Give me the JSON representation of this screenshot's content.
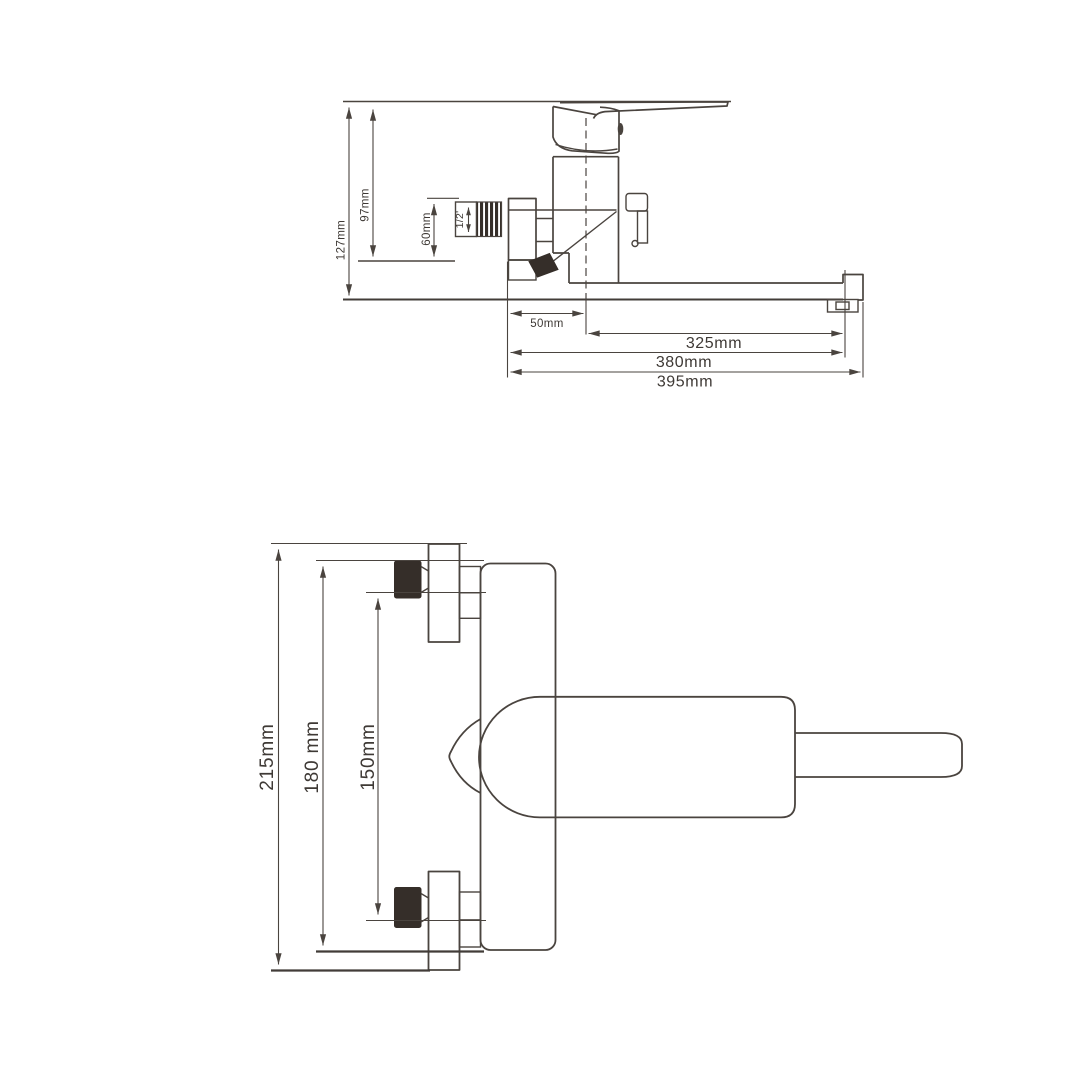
{
  "drawing": {
    "side_view": {
      "height_overall": "127mm",
      "height_to_wall": "97mm",
      "connector_height": "60mm",
      "thread_size": "1/2'",
      "wall_offset": "50mm",
      "spout_reach": "325mm",
      "length_total": "380mm",
      "length_max": "395mm"
    },
    "front_view": {
      "width_overall": "215mm",
      "body_width": "180 mm",
      "centers_distance": "150mm"
    },
    "colors": {
      "line": "#4a443f",
      "dark_fill": "#352e29",
      "text": "#3e3935",
      "background": "#ffffff"
    }
  }
}
